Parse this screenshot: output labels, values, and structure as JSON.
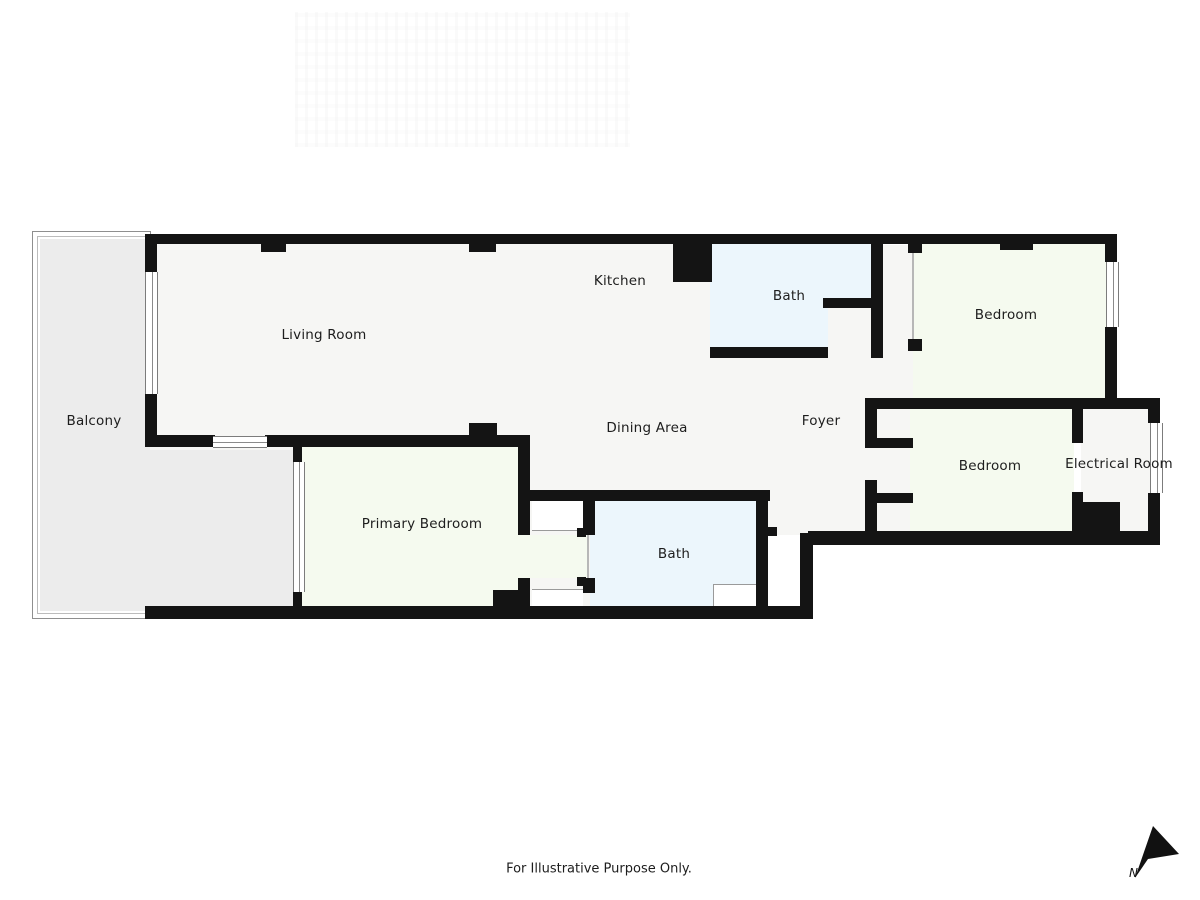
{
  "plan": {
    "rooms": [
      {
        "id": "balcony",
        "label": "Balcony"
      },
      {
        "id": "living-room",
        "label": "Living Room"
      },
      {
        "id": "kitchen",
        "label": "Kitchen"
      },
      {
        "id": "bath-upper",
        "label": "Bath"
      },
      {
        "id": "bedroom-upper",
        "label": "Bedroom"
      },
      {
        "id": "dining-area",
        "label": "Dining Area"
      },
      {
        "id": "foyer",
        "label": "Foyer"
      },
      {
        "id": "bedroom-right",
        "label": "Bedroom"
      },
      {
        "id": "electrical-room",
        "label": "Electrical Room"
      },
      {
        "id": "primary-bedroom",
        "label": "Primary Bedroom"
      },
      {
        "id": "bath-lower",
        "label": "Bath"
      }
    ],
    "footer_note": "For Illustrative Purpose Only.",
    "compass_label": "N",
    "colors": {
      "wall": "#141414",
      "floor": "#f6f6f4",
      "bedroom": "#f5faef",
      "bath": "#ecf6fc",
      "balcony": "#ececec"
    }
  }
}
